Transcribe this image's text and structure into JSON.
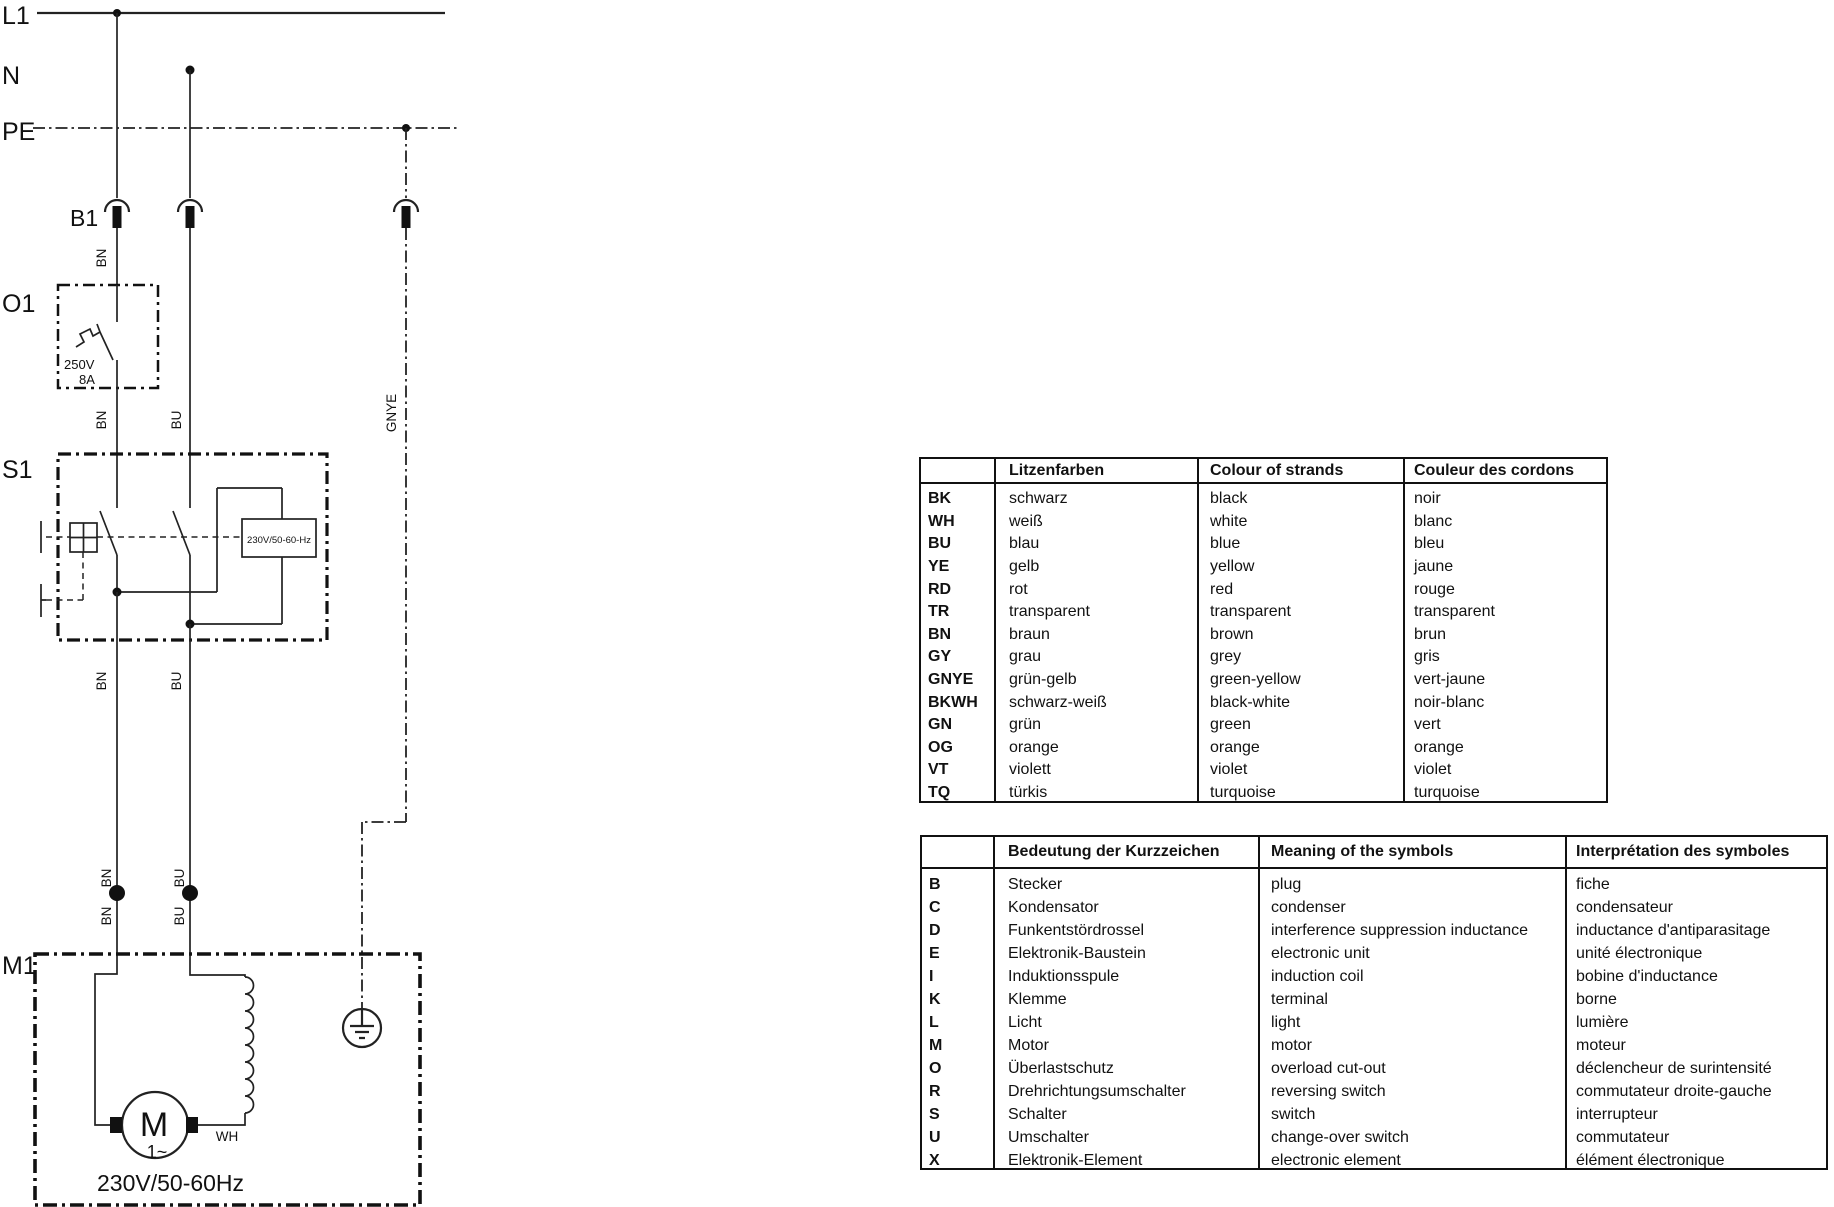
{
  "schematic": {
    "power_labels": {
      "l1": "L1",
      "n": "N",
      "pe": "PE"
    },
    "component_labels": {
      "b1": "B1",
      "o1": "O1",
      "s1": "S1",
      "m1": "M1"
    },
    "wire_labels": {
      "bn": "BN",
      "bu": "BU",
      "gnye": "GNYE",
      "wh": "WH"
    },
    "values": {
      "overload_voltage": "250V",
      "overload_current": "8A",
      "relay_rating": "230V/50-60-Hz",
      "motor_rating": "230V/50-60Hz",
      "motor_symbol": "M",
      "motor_phase": "1~"
    }
  },
  "tables": {
    "colors": {
      "headers": {
        "code": "",
        "de": "Litzenfarben",
        "en": "Colour of strands",
        "fr": "Couleur des cordons"
      },
      "rows": [
        {
          "code": "BK",
          "de": "schwarz",
          "en": "black",
          "fr": "noir"
        },
        {
          "code": "WH",
          "de": "weiß",
          "en": "white",
          "fr": "blanc"
        },
        {
          "code": "BU",
          "de": "blau",
          "en": "blue",
          "fr": "bleu"
        },
        {
          "code": "YE",
          "de": "gelb",
          "en": "yellow",
          "fr": "jaune"
        },
        {
          "code": "RD",
          "de": "rot",
          "en": "red",
          "fr": "rouge"
        },
        {
          "code": "TR",
          "de": "transparent",
          "en": "transparent",
          "fr": "transparent"
        },
        {
          "code": "BN",
          "de": "braun",
          "en": "brown",
          "fr": "brun"
        },
        {
          "code": "GY",
          "de": "grau",
          "en": "grey",
          "fr": "gris"
        },
        {
          "code": "GNYE",
          "de": "grün-gelb",
          "en": "green-yellow",
          "fr": "vert-jaune"
        },
        {
          "code": "BKWH",
          "de": "schwarz-weiß",
          "en": "black-white",
          "fr": "noir-blanc"
        },
        {
          "code": "GN",
          "de": "grün",
          "en": "green",
          "fr": "vert"
        },
        {
          "code": "OG",
          "de": "orange",
          "en": "orange",
          "fr": "orange"
        },
        {
          "code": "VT",
          "de": "violett",
          "en": "violet",
          "fr": "violet"
        },
        {
          "code": "TQ",
          "de": "türkis",
          "en": "turquoise",
          "fr": "turquoise"
        }
      ]
    },
    "symbols": {
      "headers": {
        "code": "",
        "de": "Bedeutung der Kurzzeichen",
        "en": "Meaning of the symbols",
        "fr": "Interprétation des symboles"
      },
      "rows": [
        {
          "code": "B",
          "de": "Stecker",
          "en": "plug",
          "fr": "fiche"
        },
        {
          "code": "C",
          "de": "Kondensator",
          "en": "condenser",
          "fr": "condensateur"
        },
        {
          "code": "D",
          "de": "Funkentstördrossel",
          "en": "interference suppression inductance",
          "fr": "inductance d'antiparasitage"
        },
        {
          "code": "E",
          "de": "Elektronik-Baustein",
          "en": "electronic unit",
          "fr": "unité électronique"
        },
        {
          "code": "I",
          "de": "Induktionsspule",
          "en": "induction coil",
          "fr": "bobine d'inductance"
        },
        {
          "code": "K",
          "de": "Klemme",
          "en": "terminal",
          "fr": "borne"
        },
        {
          "code": "L",
          "de": "Licht",
          "en": "light",
          "fr": "lumière"
        },
        {
          "code": "M",
          "de": "Motor",
          "en": "motor",
          "fr": "moteur"
        },
        {
          "code": "O",
          "de": "Überlastschutz",
          "en": "overload cut-out",
          "fr": "déclencheur de surintensité"
        },
        {
          "code": "R",
          "de": "Drehrichtungsumschalter",
          "en": "reversing switch",
          "fr": "commutateur droite-gauche"
        },
        {
          "code": "S",
          "de": "Schalter",
          "en": "switch",
          "fr": "interrupteur"
        },
        {
          "code": "U",
          "de": "Umschalter",
          "en": "change-over switch",
          "fr": "commutateur"
        },
        {
          "code": "X",
          "de": "Elektronik-Element",
          "en": "electronic element",
          "fr": "élément électronique"
        }
      ]
    }
  }
}
